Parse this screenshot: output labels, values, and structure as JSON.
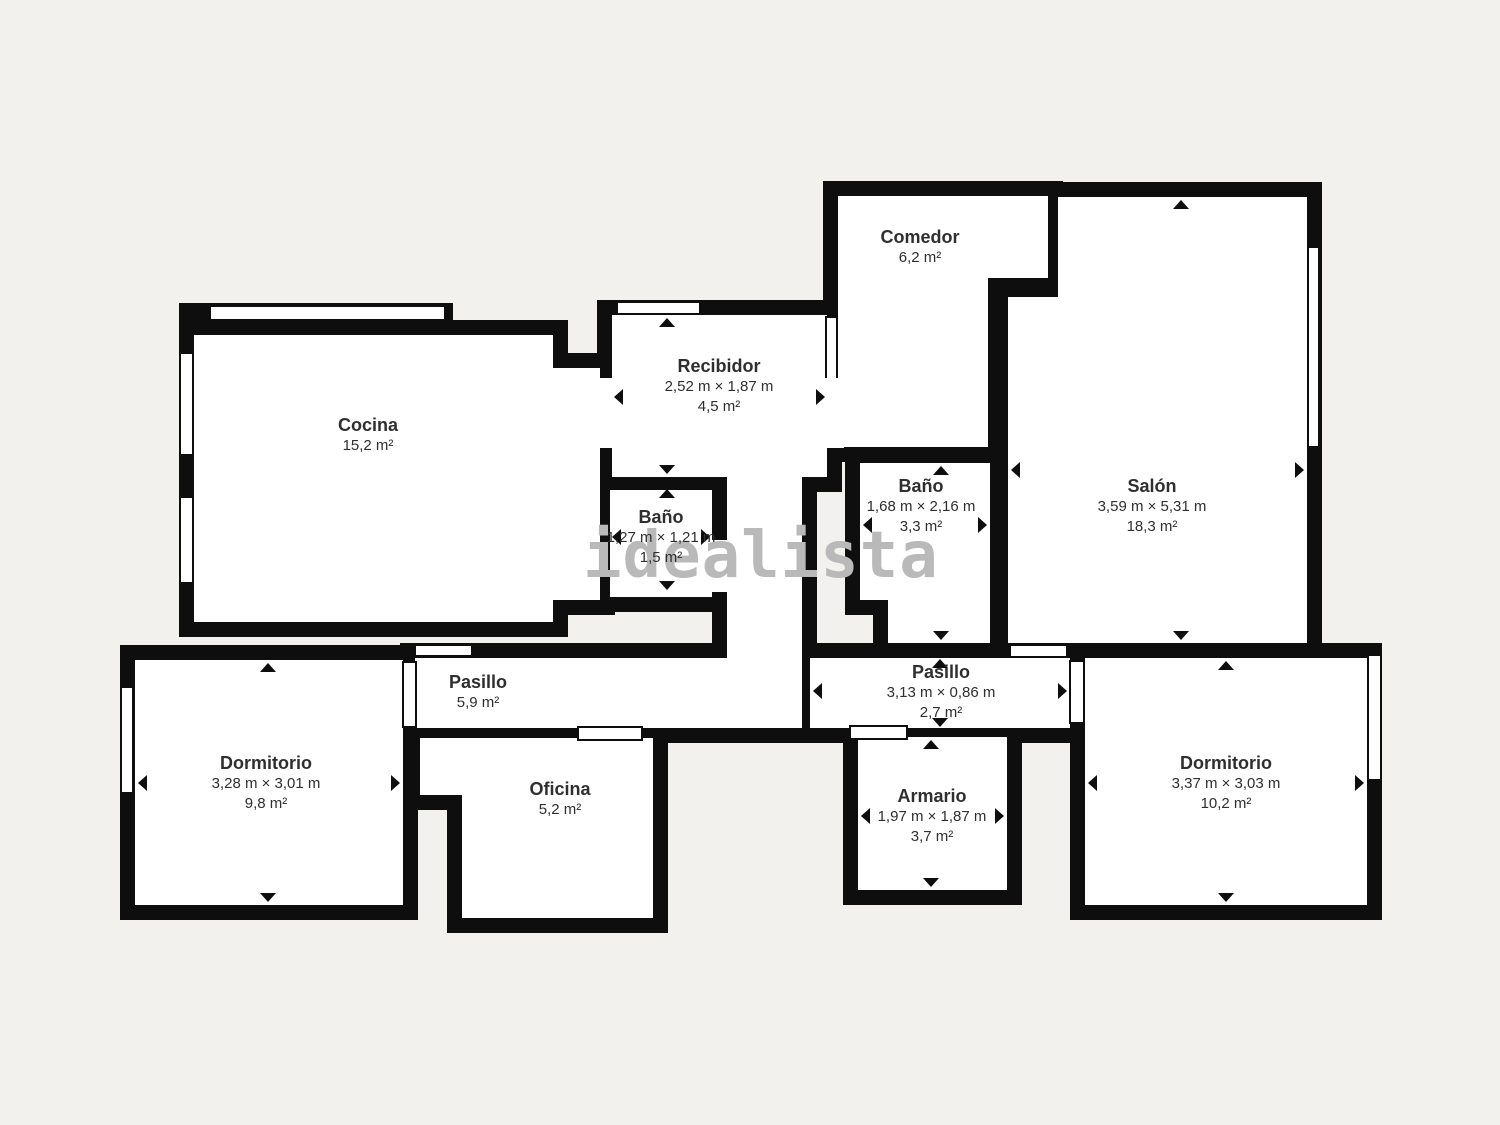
{
  "colors": {
    "background": "#f3f1ee",
    "wall": "#0e0e0e",
    "room": "#ffffff",
    "text": "#2f2f2f",
    "watermark": "#b9b9b9"
  },
  "watermark": {
    "text": "idealista"
  },
  "rooms": [
    {
      "id": "comedor",
      "name": "Comedor",
      "area": "6,2 m²"
    },
    {
      "id": "cocina",
      "name": "Cocina",
      "area": "15,2 m²"
    },
    {
      "id": "recibidor",
      "name": "Recibidor",
      "dims": "2,52 m × 1,87 m",
      "area": "4,5 m²"
    },
    {
      "id": "bano-recibidor",
      "name": "Baño",
      "dims": "1,27 m × 1,21 m",
      "area": "1,5 m²"
    },
    {
      "id": "bano",
      "name": "Baño",
      "dims": "1,68 m × 2,16 m",
      "area": "3,3 m²"
    },
    {
      "id": "salon",
      "name": "Salón",
      "dims": "3,59 m × 5,31 m",
      "area": "18,3 m²"
    },
    {
      "id": "pasillo-izquierdo",
      "name": "Pasillo",
      "area": "5,9 m²"
    },
    {
      "id": "pasillo-derecho",
      "name": "Pasillo",
      "dims": "3,13 m × 0,86 m",
      "area": "2,7 m²"
    },
    {
      "id": "dormitorio-izquierdo",
      "name": "Dormitorio",
      "dims": "3,28 m × 3,01 m",
      "area": "9,8 m²"
    },
    {
      "id": "oficina",
      "name": "Oficina",
      "area": "5,2 m²"
    },
    {
      "id": "armario",
      "name": "Armario",
      "dims": "1,97 m × 1,87 m",
      "area": "3,7 m²"
    },
    {
      "id": "dormitorio-derecho",
      "name": "Dormitorio",
      "dims": "3,37 m × 3,03 m",
      "area": "10,2 m²"
    }
  ]
}
